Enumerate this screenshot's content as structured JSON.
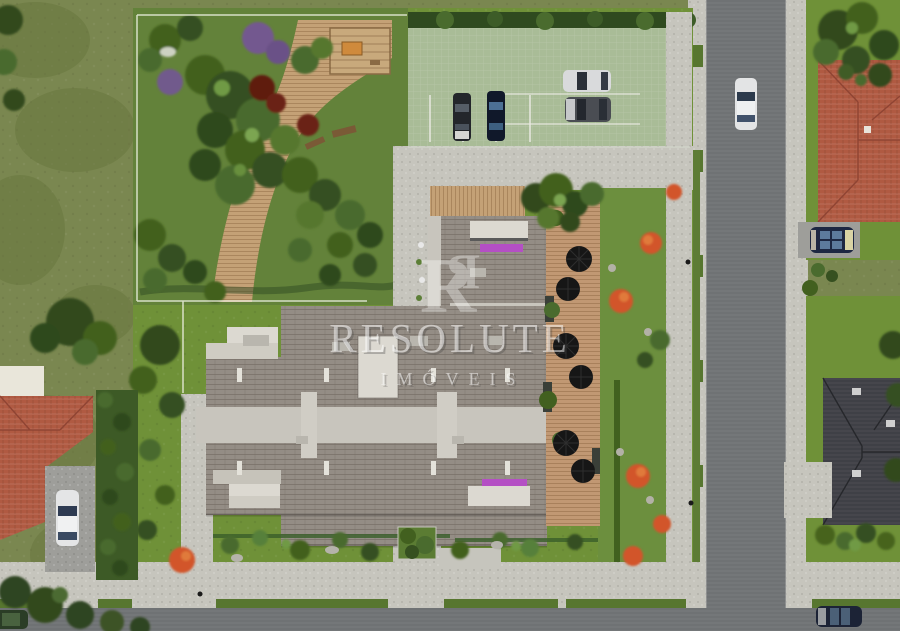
{
  "watermark": {
    "monogram": "R",
    "brand": "RESOLUTE",
    "subtitle": "IMÓVEIS"
  },
  "scene": {
    "description": "Top-down aerial 3D rendering of a residential condominium site plan",
    "areas": [
      "open field",
      "private park with wooden trail and pergola",
      "resident parking lot",
      "main apartment building",
      "pool-side wooden deck with umbrellas",
      "east garden lawn",
      "vertical street",
      "bottom street",
      "neighbor house red roof NE",
      "neighbor house dark roof SE",
      "neighbor house red roof SW"
    ]
  },
  "vehicles": [
    {
      "id": "parking-sedan-black",
      "location": "parking lot stall 1",
      "hex": "#23262b"
    },
    {
      "id": "parking-sedan-navy",
      "location": "parking lot stall 2",
      "hex": "#10182a"
    },
    {
      "id": "parking-sedan-silver",
      "location": "parking lot row right top",
      "hex": "#d9dadc"
    },
    {
      "id": "parking-sedan-gray",
      "location": "parking lot row right bottom",
      "hex": "#4a4d53"
    },
    {
      "id": "street-car-white",
      "location": "vertical street",
      "hex": "#e3e4e5"
    },
    {
      "id": "driveway-car-navy",
      "location": "north-east house driveway",
      "hex": "#1d2742"
    },
    {
      "id": "driveway-car-white",
      "location": "south-west house driveway",
      "hex": "#e4e5e6"
    },
    {
      "id": "corner-car-green",
      "location": "bottom-left street corner",
      "hex": "#2b3d26"
    },
    {
      "id": "street-car-navy",
      "location": "bottom street right",
      "hex": "#1c2336"
    }
  ],
  "colors": {
    "field": "#7a8750",
    "fieldDark": "#69773f",
    "lawn": "#6f9138",
    "parkLawn": "#63823a",
    "treeDark": "#33491f",
    "treeMid": "#4a6b2e",
    "treeLight": "#6f9a45",
    "treePurple": "#73588f",
    "treeRed": "#5e1d0e",
    "deckTan": "#c4a176",
    "deckWood": "#c19873",
    "parkingGreen": "#a9bc97",
    "hedge": "#2f4a1f",
    "paver": "#c6c5bd",
    "road": "#6f7274",
    "roofMain": "#948d85",
    "roofLight": "#c8c5bd",
    "roofWhite": "#dcd9d1",
    "roofRed": "#b05a42",
    "roofRedLine": "#8f4433",
    "roofDark": "#3f4046",
    "awning": "#b44fc4",
    "orangeBush": "#d2552a",
    "fence": "#eef0e2",
    "umbrella": "#161616",
    "driveway": "#9e9e9a",
    "watermark": "rgba(255,255,255,0.52)"
  }
}
